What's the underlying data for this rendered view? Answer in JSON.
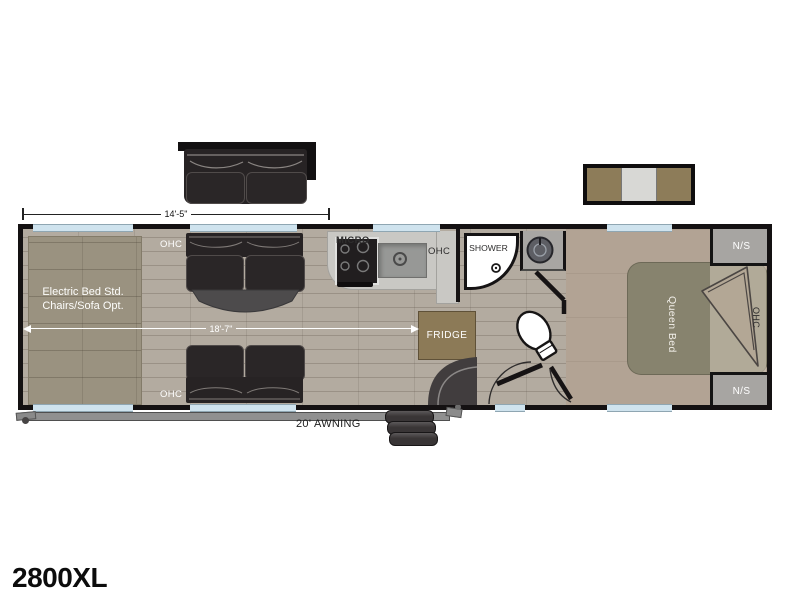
{
  "model": "2800XL",
  "dims": {
    "garage": "14'-5\"",
    "main": "18'-7\"",
    "awning": "20' AWNING"
  },
  "labels": {
    "garage_line1": "Electric Bed Std.",
    "garage_line2": "Chairs/Sofa Opt.",
    "ohc": "OHC",
    "micro": "MICRO",
    "shower": "SHOWER",
    "fridge": "FRIDGE",
    "queen_bed": "Queen Bed",
    "ns": "N/S"
  },
  "colors": {
    "wall": "#141112",
    "floor": "#b3aba0",
    "garage_bed": "#9a9280",
    "bedroom_floor": "#b2a394",
    "bed": "#87836e",
    "furniture_dark": "#272324",
    "counter": "#c9c8c4",
    "wood": "#8c7a57",
    "window": "#cfe3ee",
    "nightstand": "#a7a5a2"
  }
}
